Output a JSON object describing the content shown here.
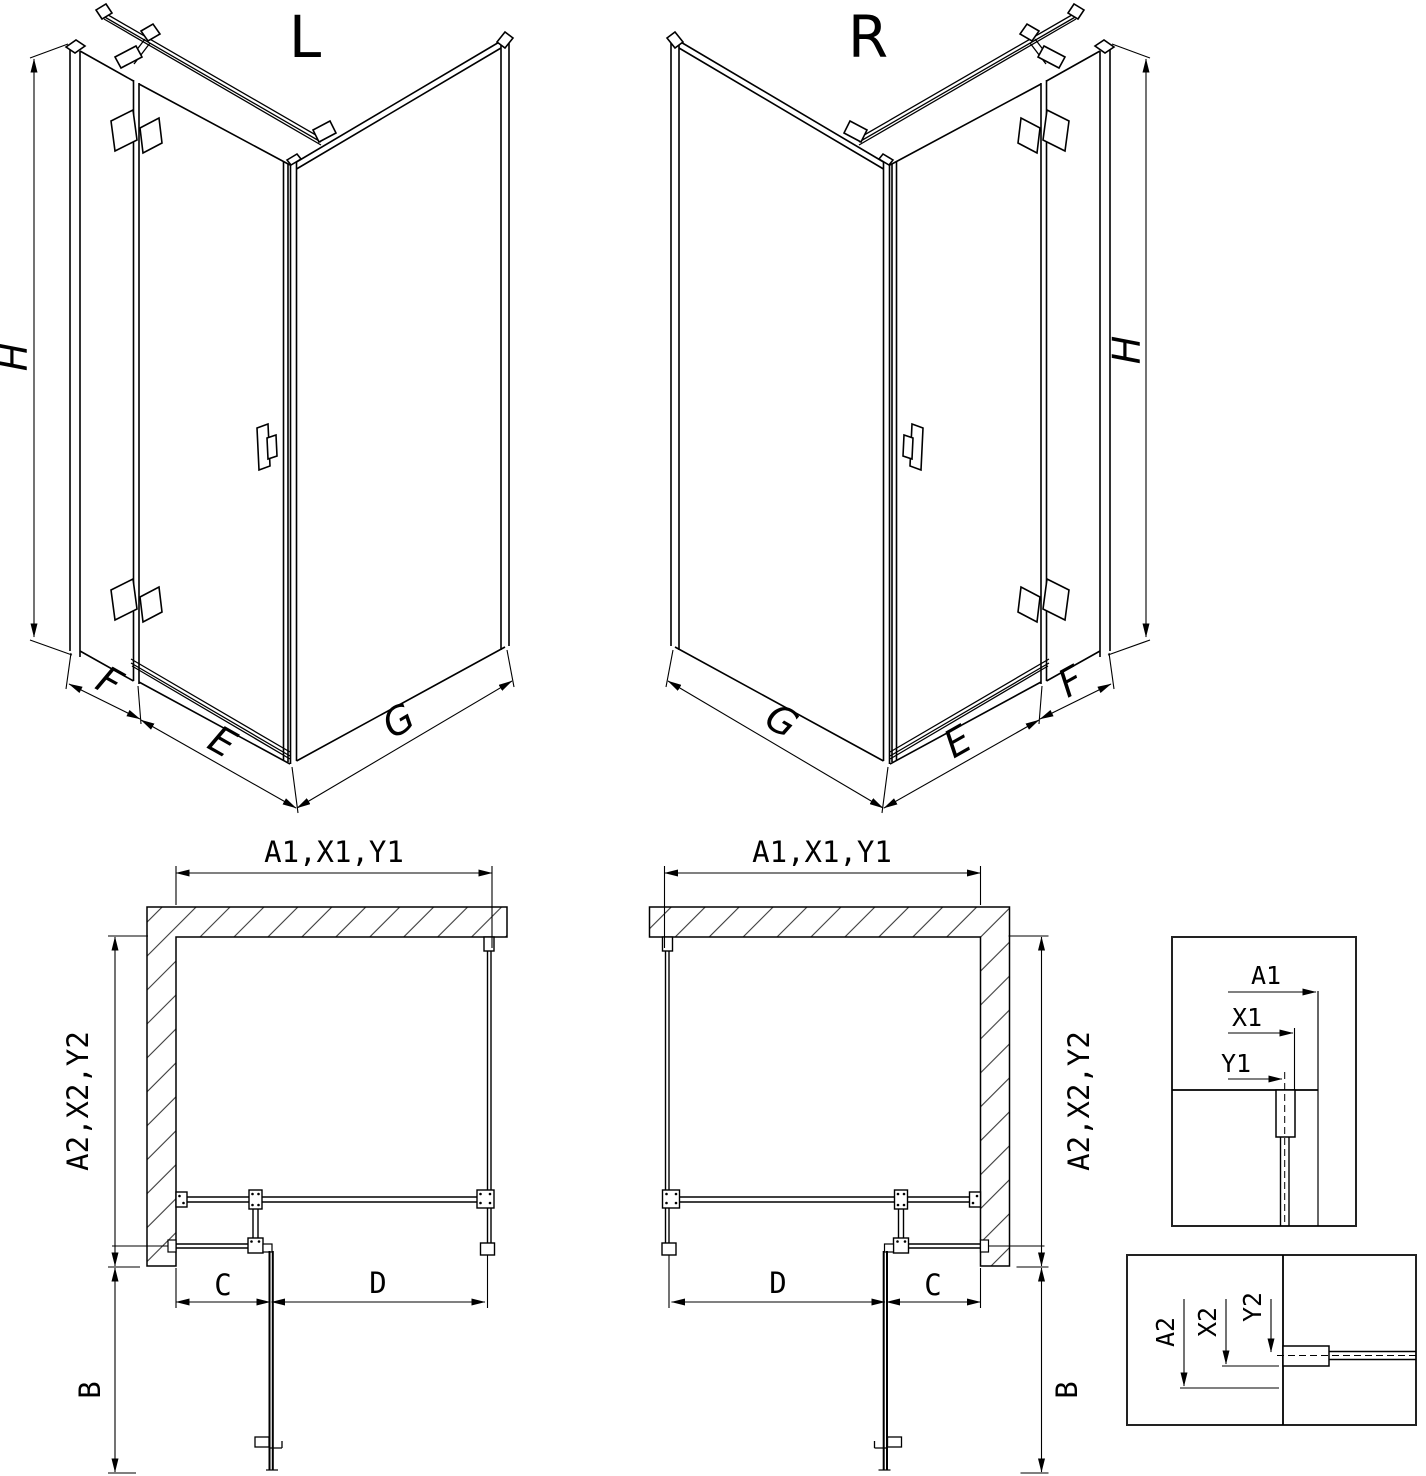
{
  "page": {
    "background": "#ffffff",
    "line_color": "#000000"
  },
  "iso_left": {
    "title": "L",
    "dim_height": "H",
    "dim_wall_side": "F",
    "dim_door": "E",
    "dim_side_panel": "G"
  },
  "iso_right": {
    "title": "R",
    "dim_height": "H",
    "dim_wall_side": "F",
    "dim_door": "E",
    "dim_side_panel": "G"
  },
  "plan_left": {
    "dim_top": "A1,X1,Y1",
    "dim_side": "A2,X2,Y2",
    "dim_depth": "B",
    "dim_fixed": "C",
    "dim_door": "D"
  },
  "plan_right": {
    "dim_top": "A1,X1,Y1",
    "dim_side": "A2,X2,Y2",
    "dim_depth": "B",
    "dim_fixed": "C",
    "dim_door": "D"
  },
  "detail_top": {
    "dim_a1": "A1",
    "dim_x1": "X1",
    "dim_y1": "Y1"
  },
  "detail_bottom": {
    "dim_a2": "A2",
    "dim_x2": "X2",
    "dim_y2": "Y2"
  }
}
